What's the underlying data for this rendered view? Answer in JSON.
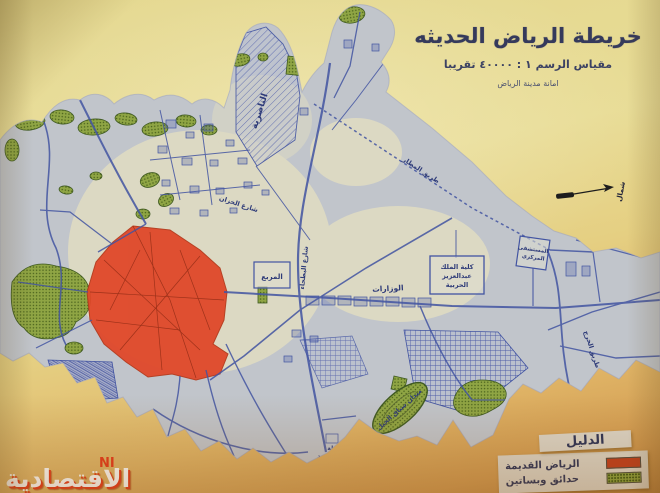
{
  "title_block": {
    "title": "خريطة الرياض الحديثه",
    "scale": "مقياس الرسم ١ : ٤٠٠٠٠ تقريبا",
    "authority": "امانة مدينة الرياض"
  },
  "compass": {
    "label": "شمال"
  },
  "legend": {
    "title": "الدليل",
    "items": [
      {
        "label": "الرياض القديمة",
        "color": "#c03c1c",
        "swatch": "solid-red"
      },
      {
        "label": "حدائق وبساتين",
        "color": "#8aa23c",
        "swatch": "stipple-green"
      }
    ]
  },
  "watermark": {
    "text": "الاقتصادية",
    "fragment": "NI"
  },
  "map_labels": {
    "nasiriyah": "الناصرية",
    "murabba": "المربع",
    "ministries": "الوزارات",
    "college_line1": "كلية الملك",
    "college_line2": "عبدالعزيز",
    "college_line3": "الحربية",
    "hospital_line1": "المستشفى",
    "hospital_line2": "المركزي",
    "racetrack": "ميدان سباق الخيل",
    "station_line1": "محطة",
    "station_line2": "السكة الحديد",
    "street_khazan": "شارع الخزان",
    "street_batha": "شارع البطحاء",
    "street_airport": "طريق المطار",
    "street_kharj": "طريق الخرج"
  },
  "colors": {
    "old_riyadh_fill": "#e0482a",
    "gardens_fill": "#8fa544",
    "street_ink": "#4254a2",
    "paper": "#e8dc96",
    "shaded_district": "#aab4d2"
  }
}
